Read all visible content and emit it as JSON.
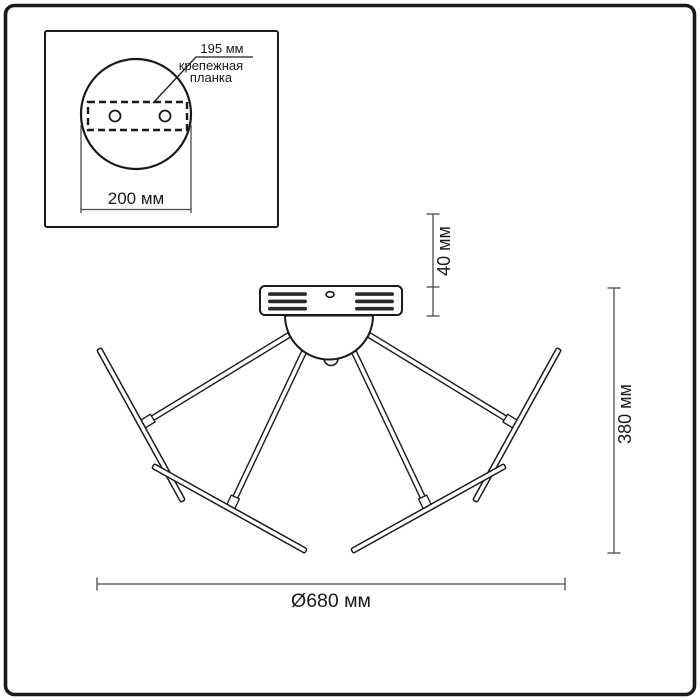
{
  "inset": {
    "plate_width_label": "195 мм",
    "plate_name_line1": "крепежная",
    "plate_name_line2": "планка",
    "base_diameter_label": "200 мм"
  },
  "dims": {
    "canopy_height_label": "40 мм",
    "total_height_label": "380 мм",
    "total_diameter_label": "Ø680 мм"
  },
  "colors": {
    "line": "#1a1a1a",
    "dimension_line": "#4a4a4a",
    "vent_slot_fill": "#2a2a2a",
    "background": "#ffffff"
  }
}
